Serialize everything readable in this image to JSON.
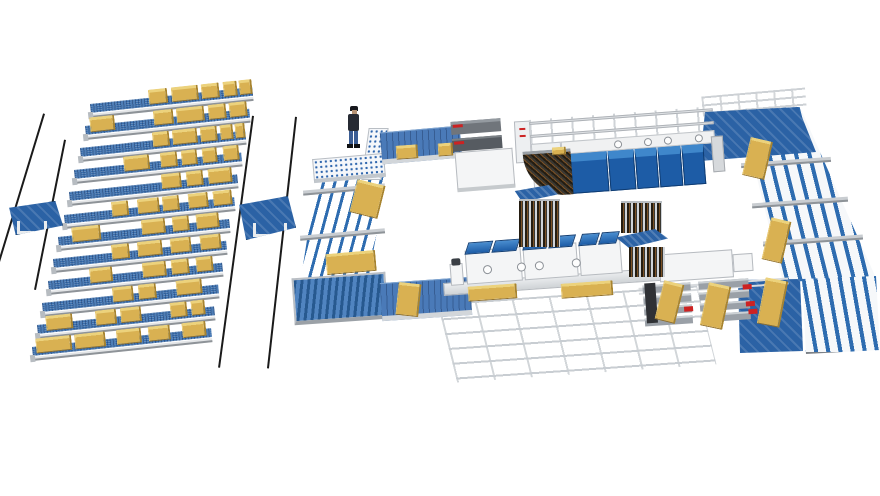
{
  "palette": {
    "background": "#ffffff",
    "conveyor_blue": "#3a6fae",
    "belt_blue": "#4a7ab8",
    "table_blue": "#2b62a5",
    "module_blue": "#1d5ca6",
    "module_blue_top": "#3f87cb",
    "rail_blue": "#2e6cb0",
    "pallet_yellow": "#d9b152",
    "pallet_yellow_top": "#ecd27c",
    "pallet_yellow_side": "#a8842f",
    "machine_white": "#f2f3f4",
    "frame_gray": "#c8ccd0",
    "dark_gray": "#565b61",
    "accent_red": "#cc2222",
    "ground_rail_black": "#1a1a1a",
    "strip_dark": "#241d12",
    "strip_rust": "#7b5126"
  },
  "storage": {
    "ground_rails": [
      [
        45,
        114,
        0,
        262
      ],
      [
        66,
        140,
        36,
        290
      ],
      [
        254,
        116,
        220,
        368
      ],
      [
        297,
        117,
        269,
        368
      ]
    ],
    "transfer_cars": [
      {
        "x": 8,
        "y": 201,
        "w": 55,
        "h": 34,
        "frame": {
          "x": 8,
          "y": 19,
          "w": 30,
          "h": 13
        }
      },
      {
        "x": 238,
        "y": 196,
        "w": 58,
        "h": 44,
        "frame": {
          "x": 14,
          "y": 26,
          "w": 34,
          "h": 14
        }
      }
    ],
    "row_tilt_deg": -6,
    "rows": [
      {
        "x": 90,
        "y": 104,
        "len": 163,
        "stacks": [
          [
            0.36,
            0.12
          ],
          [
            0.5,
            0.17
          ],
          [
            0.69,
            0.11
          ],
          [
            0.82,
            0.09
          ],
          [
            0.92,
            0.08
          ]
        ]
      },
      {
        "x": 85,
        "y": 126,
        "len": 165,
        "stacks": [
          [
            0.03,
            0.15
          ],
          [
            0.42,
            0.12
          ],
          [
            0.56,
            0.17
          ],
          [
            0.75,
            0.11
          ],
          [
            0.88,
            0.11
          ]
        ]
      },
      {
        "x": 80,
        "y": 148,
        "len": 166,
        "stacks": [
          [
            0.44,
            0.1
          ],
          [
            0.56,
            0.15
          ],
          [
            0.73,
            0.1
          ],
          [
            0.85,
            0.08
          ],
          [
            0.94,
            0.06
          ]
        ]
      },
      {
        "x": 74,
        "y": 170,
        "len": 168,
        "stacks": [
          [
            0.3,
            0.15
          ],
          [
            0.52,
            0.1
          ],
          [
            0.64,
            0.1
          ],
          [
            0.77,
            0.09
          ],
          [
            0.89,
            0.1
          ]
        ]
      },
      {
        "x": 69,
        "y": 192,
        "len": 169,
        "stacks": [
          [
            0.55,
            0.12
          ],
          [
            0.7,
            0.1
          ],
          [
            0.83,
            0.14
          ]
        ]
      },
      {
        "x": 64,
        "y": 215,
        "len": 171,
        "stacks": [
          [
            0.28,
            0.1
          ],
          [
            0.43,
            0.13
          ],
          [
            0.58,
            0.1
          ],
          [
            0.73,
            0.12
          ],
          [
            0.88,
            0.11
          ]
        ]
      },
      {
        "x": 58,
        "y": 237,
        "len": 172,
        "stacks": [
          [
            0.08,
            0.17
          ],
          [
            0.49,
            0.14
          ],
          [
            0.67,
            0.1
          ],
          [
            0.81,
            0.13
          ]
        ]
      },
      {
        "x": 53,
        "y": 259,
        "len": 174,
        "stacks": [
          [
            0.34,
            0.1
          ],
          [
            0.49,
            0.14
          ],
          [
            0.68,
            0.12
          ],
          [
            0.85,
            0.12
          ]
        ]
      },
      {
        "x": 48,
        "y": 281,
        "len": 175,
        "stacks": [
          [
            0.24,
            0.13
          ],
          [
            0.54,
            0.14
          ],
          [
            0.71,
            0.1
          ],
          [
            0.85,
            0.1
          ]
        ]
      },
      {
        "x": 42,
        "y": 303,
        "len": 177,
        "stacks": [
          [
            0.4,
            0.12
          ],
          [
            0.55,
            0.1
          ],
          [
            0.76,
            0.15
          ]
        ]
      },
      {
        "x": 37,
        "y": 325,
        "len": 178,
        "stacks": [
          [
            0.05,
            0.15
          ],
          [
            0.33,
            0.12
          ],
          [
            0.47,
            0.12
          ],
          [
            0.75,
            0.1
          ],
          [
            0.87,
            0.08
          ]
        ]
      },
      {
        "x": 32,
        "y": 347,
        "len": 180,
        "stacks": [
          [
            0.02,
            0.2
          ],
          [
            0.24,
            0.17
          ],
          [
            0.47,
            0.14
          ],
          [
            0.65,
            0.12
          ],
          [
            0.84,
            0.13
          ]
        ]
      }
    ]
  },
  "line": {
    "press": {
      "portholes": [
        52,
        82,
        102,
        133
      ],
      "modules": [
        [
          8,
          37
        ],
        [
          46,
          26
        ],
        [
          73,
          22
        ],
        [
          96,
          23
        ],
        [
          120,
          22
        ]
      ]
    },
    "bottom_line": {
      "machines": [
        [
          16,
          56
        ],
        [
          74,
          54
        ],
        [
          130,
          42
        ]
      ],
      "circles": [
        33,
        67,
        85,
        122
      ]
    },
    "left_crossbars": [
      [
        303,
        187,
        82
      ],
      [
        300,
        232,
        85
      ]
    ],
    "right_crossbars": [
      [
        741,
        160,
        90
      ],
      [
        752,
        200,
        96
      ],
      [
        763,
        238,
        100
      ]
    ],
    "cross_area": {
      "slab_rows": 4,
      "red_marks": [
        [
          44,
          58
        ],
        [
          104,
          40
        ],
        [
          106,
          57
        ],
        [
          108,
          65
        ]
      ]
    },
    "pallets": [
      {
        "x": 396,
        "y": 145,
        "w": 22,
        "h": 14,
        "r": -4
      },
      {
        "x": 438,
        "y": 143,
        "w": 15,
        "h": 13,
        "r": -4
      },
      {
        "x": 552,
        "y": 147,
        "w": 14,
        "h": 8,
        "r": -4
      },
      {
        "x": 353,
        "y": 182,
        "w": 29,
        "h": 34,
        "r": 14
      },
      {
        "x": 326,
        "y": 252,
        "w": 50,
        "h": 21,
        "r": -5
      },
      {
        "x": 397,
        "y": 283,
        "w": 23,
        "h": 33,
        "r": 6
      },
      {
        "x": 468,
        "y": 285,
        "w": 49,
        "h": 15,
        "r": -4
      },
      {
        "x": 561,
        "y": 282,
        "w": 52,
        "h": 15,
        "r": -4
      },
      {
        "x": 659,
        "y": 282,
        "w": 21,
        "h": 40,
        "r": 14
      },
      {
        "x": 704,
        "y": 284,
        "w": 23,
        "h": 44,
        "r": 12
      },
      {
        "x": 746,
        "y": 139,
        "w": 23,
        "h": 39,
        "r": 13
      },
      {
        "x": 766,
        "y": 219,
        "w": 21,
        "h": 43,
        "r": 13
      },
      {
        "x": 761,
        "y": 279,
        "w": 23,
        "h": 47,
        "r": 11
      }
    ]
  }
}
